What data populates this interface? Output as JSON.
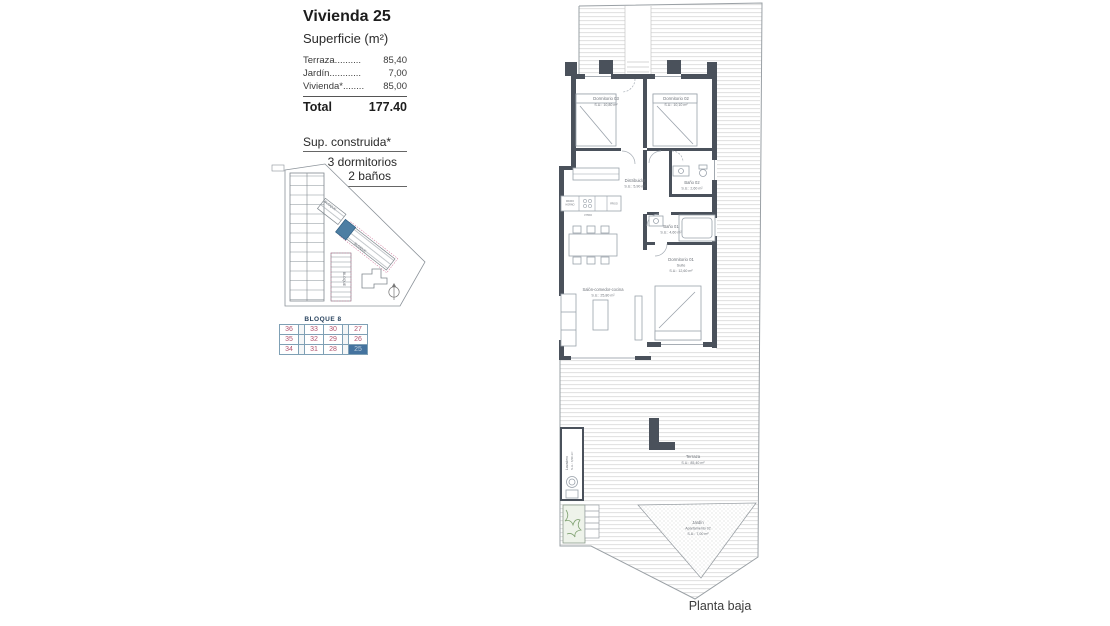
{
  "summary": {
    "title": "Vivienda 25",
    "subtitle": "Superficie (m²)",
    "rows": [
      {
        "label": "Terraza..........",
        "value": "85,40"
      },
      {
        "label": "Jardín............",
        "value": "7,00"
      },
      {
        "label": "Vivienda*........",
        "value": "85,00"
      }
    ],
    "total_label": "Total",
    "total_value": "177.40",
    "built_note": "Sup. construida*",
    "bedrooms": "3 dormitorios",
    "bathrooms": "2 baños"
  },
  "site_plan": {
    "label_a": "BLOQUE",
    "label_b": "BLOQUE",
    "label_c": "BLOQUE",
    "highlight_color": "#4d7ea3"
  },
  "block_table": {
    "header": "BLOQUE 8",
    "rows": [
      {
        "c0": "36",
        "c1": "33",
        "c2": "30",
        "c3": "27"
      },
      {
        "c0": "35",
        "c1": "32",
        "c2": "29",
        "c3": "26"
      },
      {
        "c0": "34",
        "c1": "31",
        "c2": "28",
        "c3": "25"
      }
    ]
  },
  "floor_plan": {
    "rooms": {
      "dorm3": {
        "name": "Dormitorio 03",
        "area": "S.U.: 10,80 m²"
      },
      "dorm2": {
        "name": "Dormitorio 02",
        "area": "S.U.: 10,10 m²"
      },
      "distribuidor": {
        "name": "Distribuidor",
        "area": "S.U.: 5,90 m²"
      },
      "bano2": {
        "name": "Baño 02",
        "area": "S.U.: 2,60 m²"
      },
      "bano1": {
        "name": "Baño 01",
        "area": "S.U.: 4,60 m²"
      },
      "suite": {
        "name": "Dormitorio 01",
        "sub": "Suite",
        "area": "S.U.: 12,60 m²"
      },
      "salon": {
        "name": "Salón-comedor-cocina",
        "area": "S.U.: 25,80 m²"
      },
      "terraza": {
        "name": "Terraza",
        "area": "S.U.: 85,40 m²"
      },
      "jardin": {
        "name": "Jardín",
        "sub": "Apartamento 02",
        "area": "S.U.: 7,00 m²"
      },
      "lavadero": {
        "name": "Lavadero",
        "area": "S.U.: 3,50 m²"
      }
    },
    "kitchen": {
      "micro": "MICRO",
      "horno": "HORNO",
      "vitro": "VITRO",
      "frigo": "FRIGO"
    },
    "caption": "Planta baja"
  },
  "colors": {
    "wall": "#4a515b",
    "highlight": "#4d7ea3",
    "table_numbers": "#b05570"
  }
}
